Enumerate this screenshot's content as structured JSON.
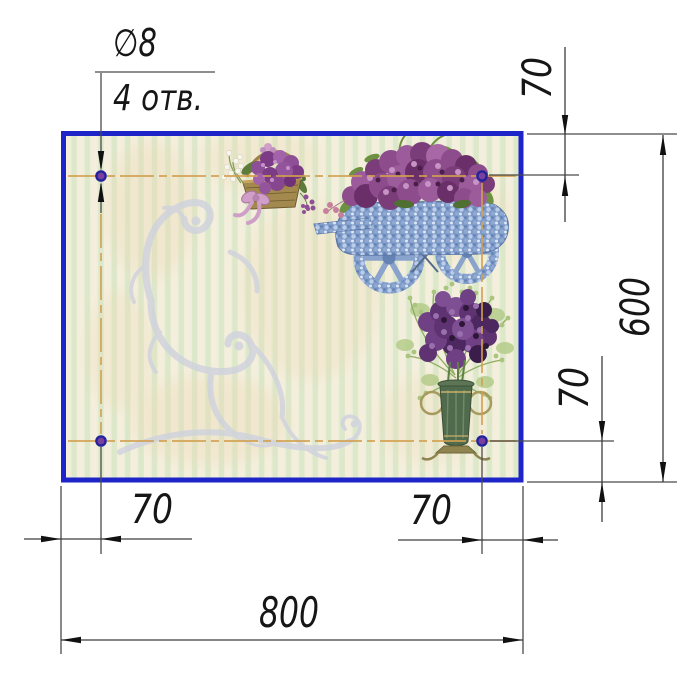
{
  "labels": {
    "hole_diameter": "∅8",
    "hole_count": "4 отв."
  },
  "dimensions": {
    "top_offset": "70",
    "height": "600",
    "right_bottom_offset": "70",
    "bottom_left_offset": "70",
    "bottom_right_offset": "70",
    "width": "800"
  },
  "colors": {
    "panel_border": "#1d25c8",
    "centerline": "#d2a050",
    "hole_fill": "#7b3f9e",
    "hole_ring": "#23239b",
    "dimension_line": "#474747",
    "stripe_cream": "#f4efdd",
    "stripe_green": "#dde7ca",
    "flourish": "#cfd2de"
  },
  "artwork": {
    "basket": "flower-basket",
    "cart": "flower-cart",
    "vase": "flower-vase",
    "ornament": "scroll-flourish"
  }
}
